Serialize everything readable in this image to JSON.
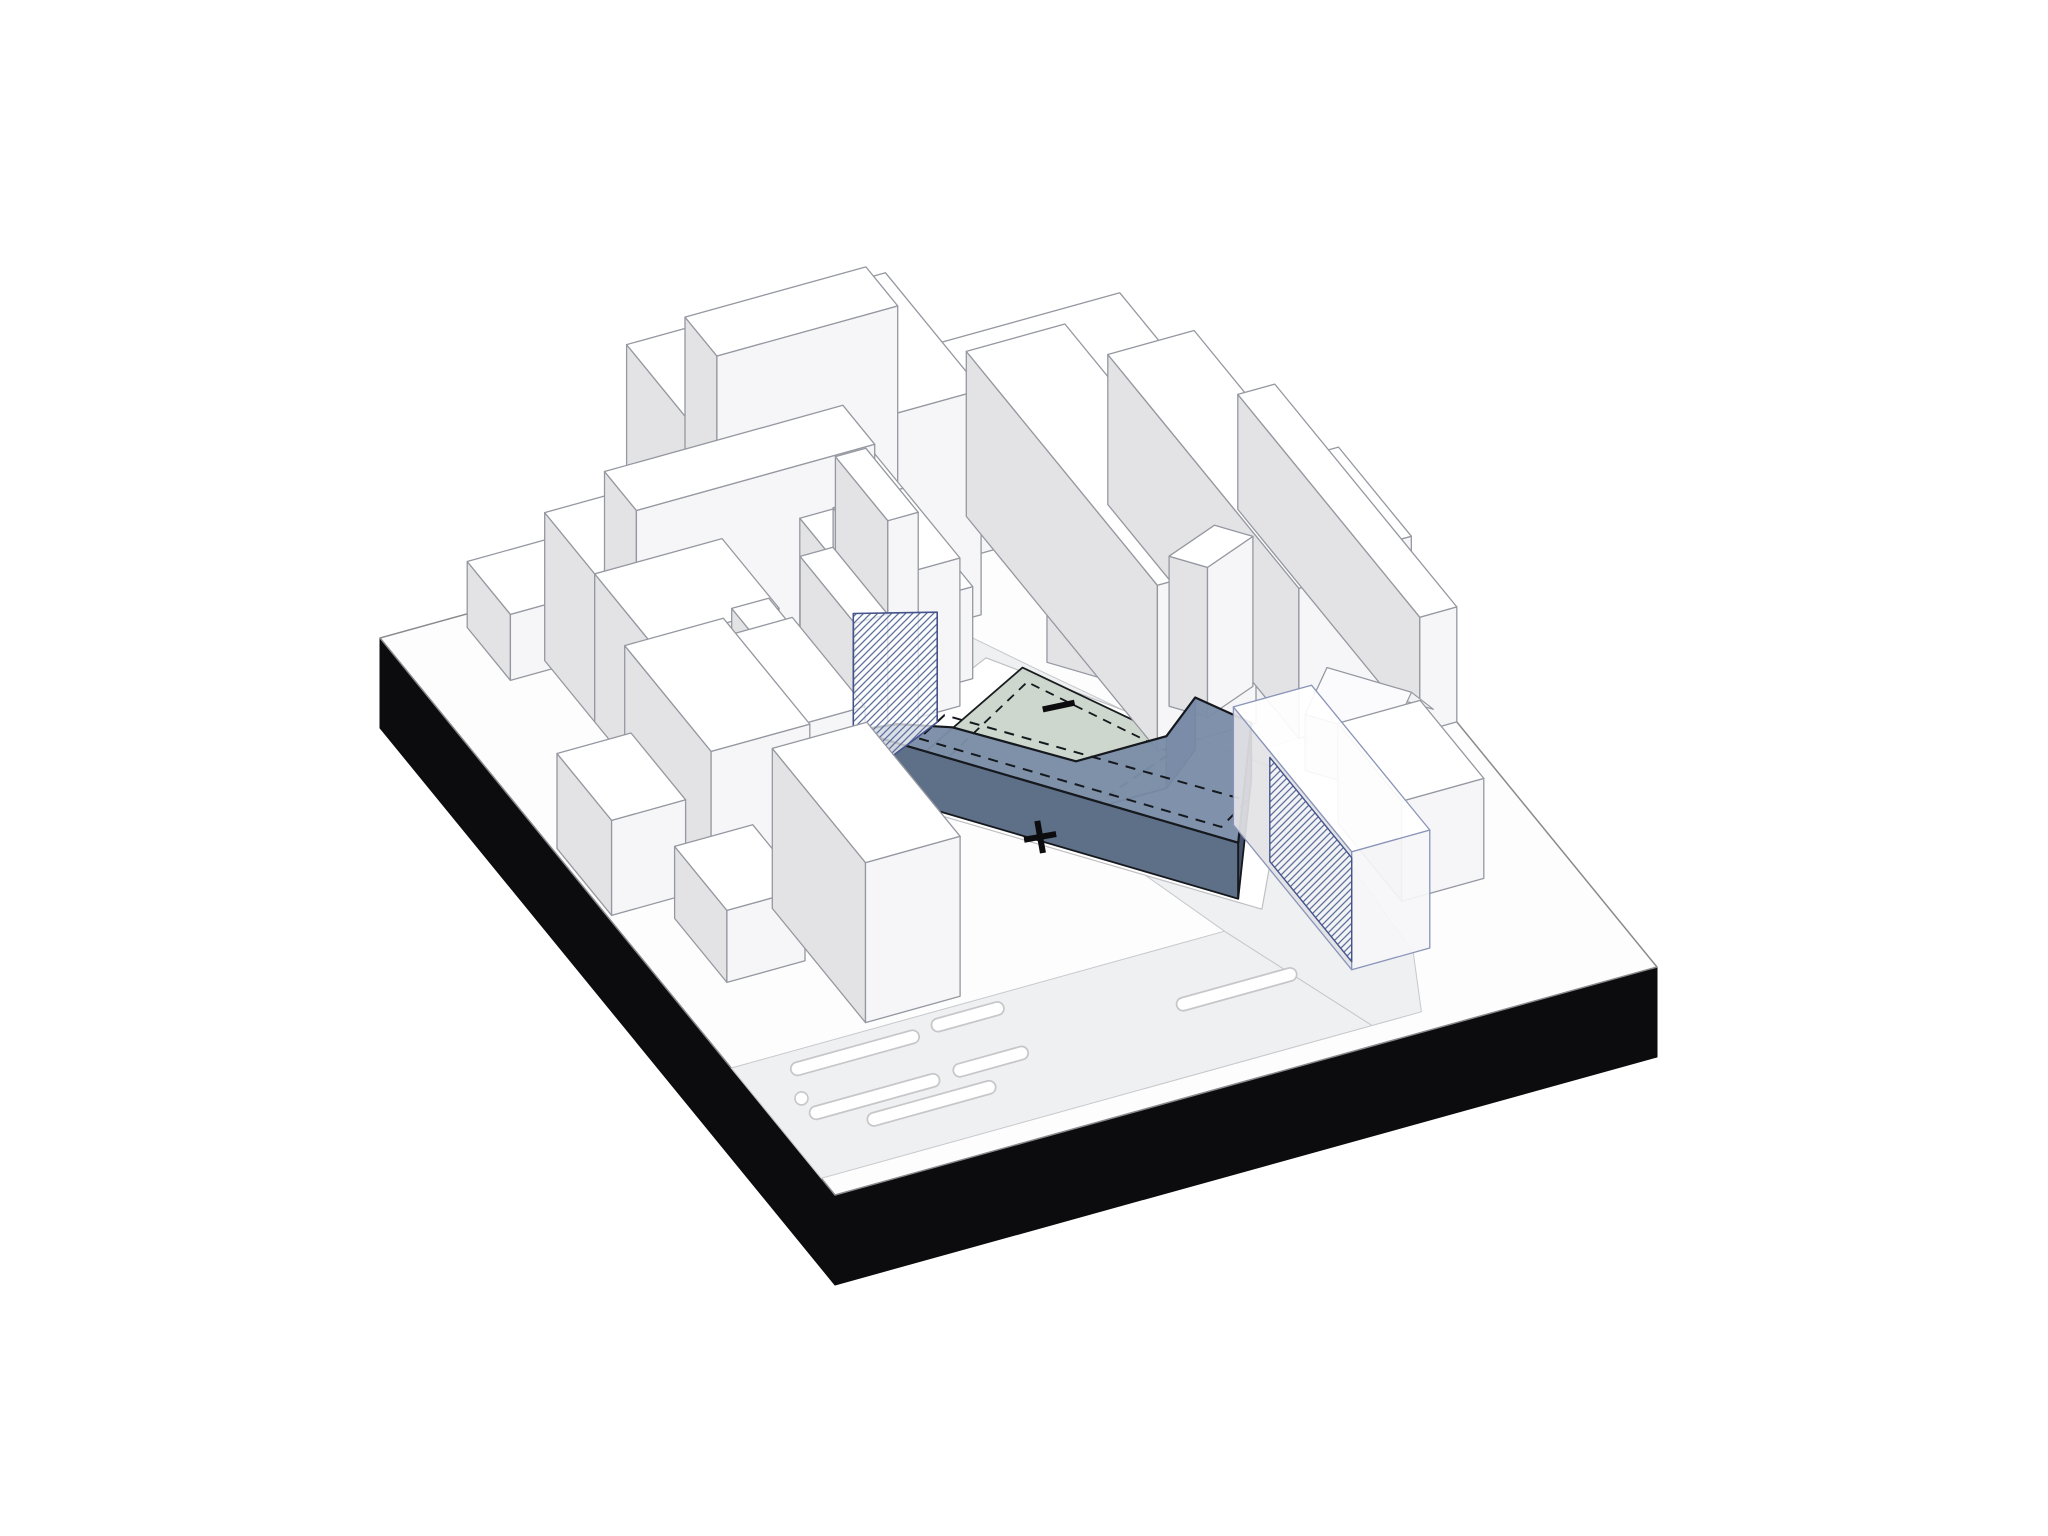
{
  "diagram": {
    "symbols": {
      "plus": "+",
      "minus": "−"
    },
    "palette": {
      "background": "#ffffff",
      "plinth_top": "#fdfdfe",
      "plinth_side": "#0c0c0e",
      "street": "#eef0f2",
      "street_edge": "#c6c8cc",
      "marking_outline": "#c7c7cb",
      "marking_fill": "#ffffff",
      "building_top": "#ffffff",
      "building_west": "#e3e3e6",
      "building_south": "#f6f6f8",
      "building_outline": "#9598a0",
      "roof_front": "#fbfbfd",
      "roof_back": "#f2f2f4",
      "gable_face": "#ececef",
      "site_parcel": "#ffffff",
      "site_green": "#c9d4c9",
      "site_green_outline": "#1a1d20",
      "site_blue_top": "#7b8ea8",
      "site_blue_front": "#5e7087",
      "site_blue_end": "#44536b",
      "site_blue_dark": "#3a475c",
      "site_blue_step": "#63748c",
      "site_outline": "#15181d",
      "dash_line": "#15181d",
      "hatch_line": "#5b6e9e",
      "hatch_border": "#44548a",
      "wireframe_blue": "#8a94b8",
      "symbol_color": "#0c0c0e"
    }
  }
}
